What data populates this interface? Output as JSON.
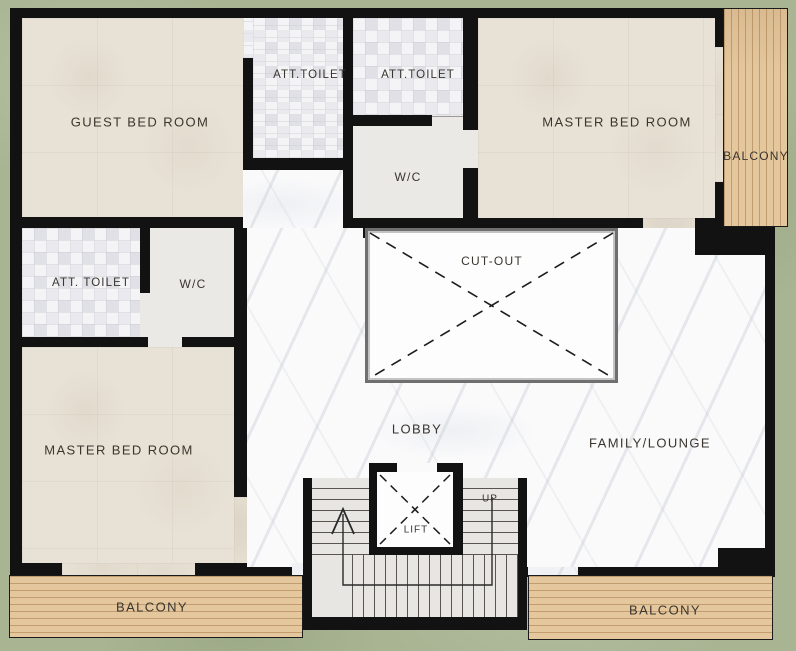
{
  "plan": {
    "labels": {
      "guest_bedroom": "GUEST BED ROOM",
      "att_toilet_top_left": "ATT.TOILET",
      "att_toilet_top_right": "ATT.TOILET",
      "master_bedroom_top": "MASTER BED ROOM",
      "balcony_right": "BALCONY",
      "wc_top": "W/C",
      "att_toilet_mid_left": "ATT. TOILET",
      "wc_mid_left": "W/C",
      "cutout": "CUT-OUT",
      "master_bedroom_bottom": "MASTER BED ROOM",
      "lobby": "LOBBY",
      "family_lounge": "FAMILY/LOUNGE",
      "stairs_up": "UP",
      "lift": "LIFT",
      "balcony_bottom_left": "BALCONY",
      "balcony_bottom_right": "BALCONY"
    },
    "colors": {
      "background_green": "#a8b492",
      "wall_black": "#121212",
      "bedroom_floor_beige": "#e8e2d6",
      "toilet_tile_floor": "#f4f4f6",
      "wc_floor_gray": "#eae9e6",
      "marble_floor": "#fafafb",
      "balcony_wood": "#e5c79d",
      "stair_floor": "#e7e6e3",
      "cutout_border_gray": "#6f6f6f",
      "label_text": "#3a352e"
    }
  }
}
